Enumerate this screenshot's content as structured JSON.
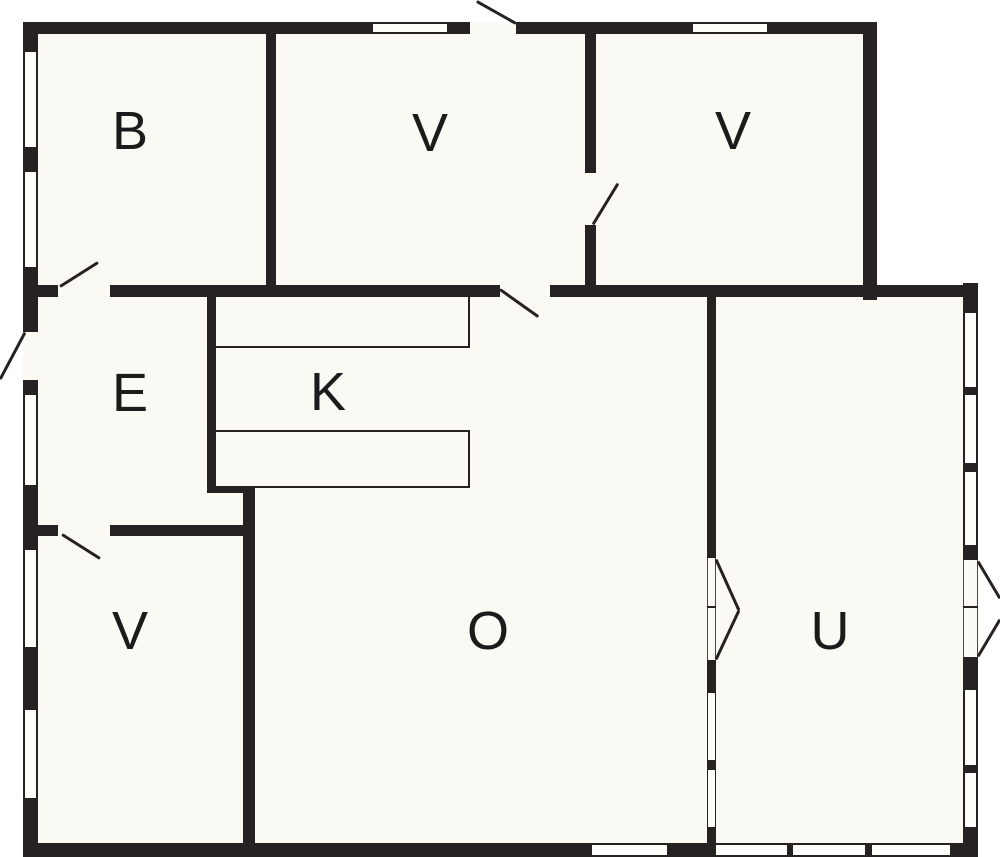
{
  "page": {
    "type": "floor-plan"
  },
  "rooms": {
    "b": {
      "label": "B"
    },
    "v1": {
      "label": "V"
    },
    "v2": {
      "label": "V"
    },
    "e": {
      "label": "E"
    },
    "k": {
      "label": "K"
    },
    "v3": {
      "label": "V"
    },
    "o": {
      "label": "O"
    },
    "u": {
      "label": "U"
    }
  },
  "colors": {
    "wall": "#262223",
    "interior": "#faf9f4",
    "outside": "#ffffff",
    "label": "#1c1a1b"
  }
}
